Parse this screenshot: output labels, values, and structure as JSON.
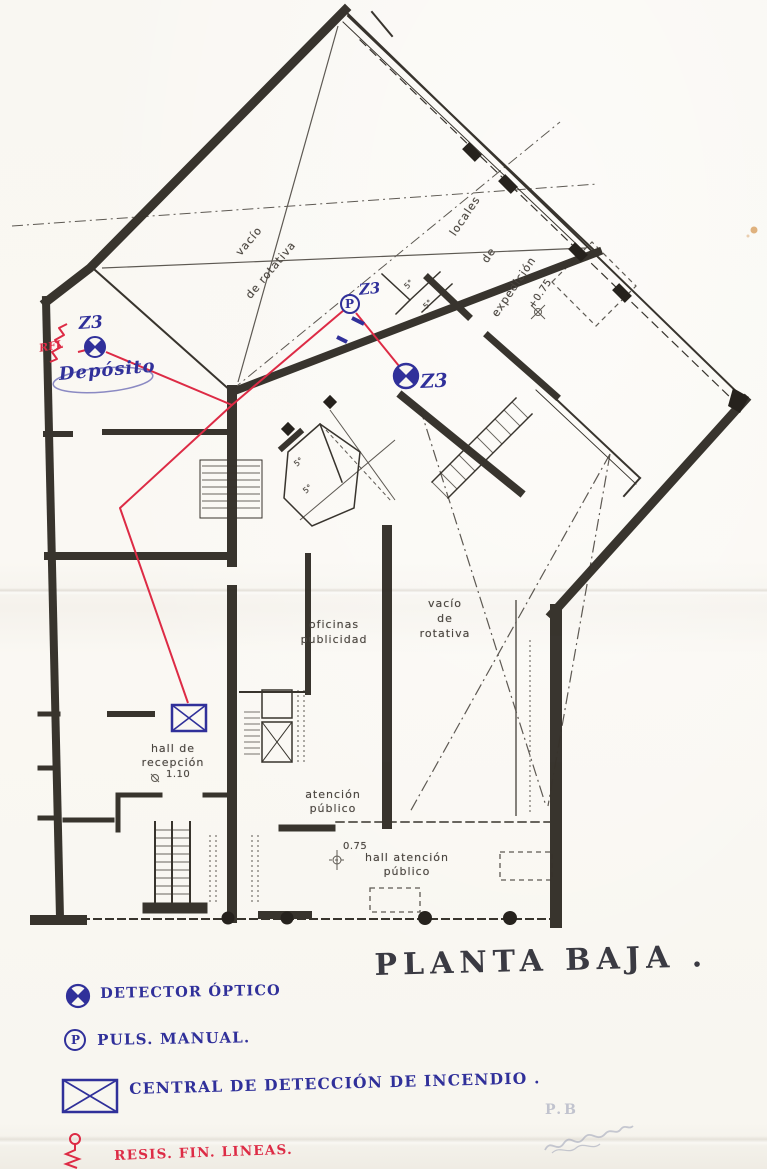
{
  "title": "PLANTA BAJA .",
  "plan_labels": {
    "vacio_rotativa_top_line1": "vacío",
    "vacio_rotativa_top_line2": "de rotativa",
    "locales_line1": "locales",
    "locales_line2": "de",
    "locales_line3": "expedición",
    "level_expedicion": "+0.75",
    "small_room_a": "5°",
    "small_room_b": "5°",
    "small_room_c": "5°",
    "small_room_d": "5°",
    "oficinas_line1": "oficinas",
    "oficinas_line2": "publicidad",
    "vacio_rotativa_mid_line1": "vacío",
    "vacio_rotativa_mid_line2": "de",
    "vacio_rotativa_mid_line3": "rotativa",
    "hall_recepcion_line1": "hall de",
    "hall_recepcion_line2": "recepción",
    "hall_recepcion_level": "1.10",
    "atencion_line1": "atención",
    "atencion_line2": "público",
    "hall_atencion_level": "0.75",
    "hall_atencion_line1": "hall atención",
    "hall_atencion_line2": "público"
  },
  "annotations": {
    "zone_label_1": "Z3",
    "zone_label_2": "Z3",
    "zone_label_3": "Z3",
    "deposito": "Depósito",
    "end_of_line_resistor": "RFL",
    "pushbutton_letter": "P",
    "pencil_note": "P.B"
  },
  "legend": {
    "detector_label": "DETECTOR ÓPTICO",
    "pushbutton_label": "PULS. MANUAL.",
    "pushbutton_letter": "P",
    "central_label": "CENTRAL DE DETECCIÓN DE INCENDIO .",
    "resistor_label": "RESIS. FIN. LINEAS."
  },
  "colors": {
    "ink_blue": "#30309a",
    "wire_red": "#dd2b45",
    "plan_ink": "#29251f",
    "paper": "#faf8f3",
    "pencil_gray": "#b6bace"
  }
}
